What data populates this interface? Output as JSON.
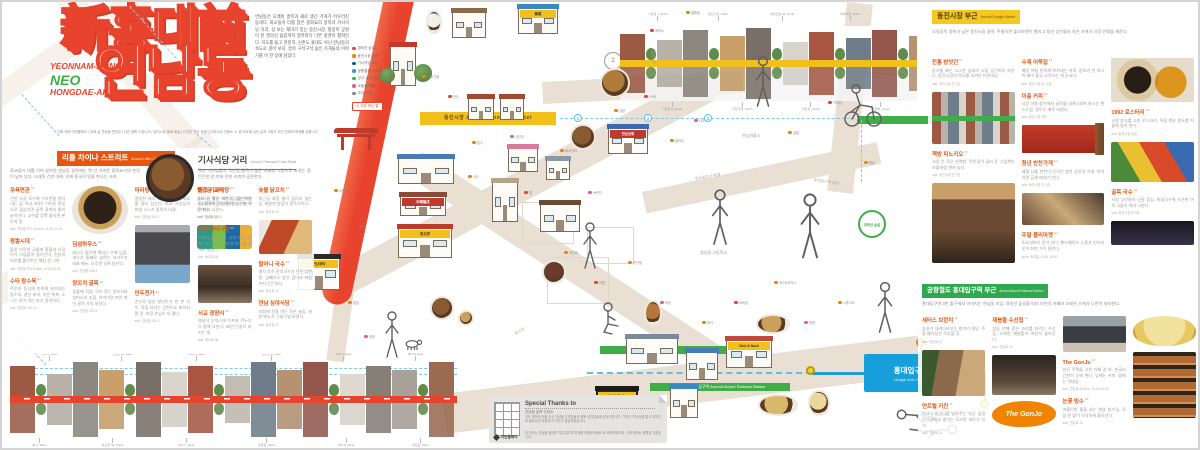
{
  "title": {
    "line1": "新홍대前",
    "line2": "연남동",
    "sub1": "YEONNAM-DONG,",
    "sub2": "NEO",
    "sub3": "HONGDAE-AP",
    "credits": "기획·제작 어반플레이 | 취재·글 연남동 편집부 | 사진 골목 스튜디오 | 일러스트 동네 화실 | 디자인 연남 공방 | 인쇄 서교 인쇄소 ※ 본 지도에 실린 글과 그림의 무단 전재와 복제를 금합니다"
  },
  "intro": {
    "text": "연남동은 오래된 골목과 새로 생긴 가게가 어우러진 동네다. 화교들이 터를 잡은 중화요리 골목과 기사식당 거리, 장 보는 재미가 있는 동진시장, 철길이 공원이 된 경의선 숲길까지 골목마다 다른 풍경이 펼쳐진다. 지도를 들고 천천히, 신촌도 홍대도 아닌 연남동의 속도로 걸어 보자. 골목 구석구석 숨은 가게들의 이야기를 이 한 장에 담았다.",
    "tag": "※ 지도 보는 법",
    "legend": [
      {
        "c": "#e8432c",
        "l": "경의선 숲길"
      },
      {
        "c": "#f08300",
        "l": "동진시장 골목"
      },
      {
        "c": "#1f4e9c",
        "l": "기사식당 거리"
      },
      {
        "c": "#2a9bd6",
        "l": "공항철도·지하철"
      },
      {
        "c": "#3fae49",
        "l": "걷고 싶은 거리"
      },
      {
        "c": "#e85c8a",
        "l": "소품샵·책방"
      },
      {
        "c": "#8a8a8a",
        "l": "주차 가능"
      }
    ]
  },
  "left": {
    "bannerA_ko": "리틀 차이나 스트리트",
    "bannerA_en": "Around Little China Street",
    "introA": "화교들이 대를 이어 살아온 연남동 골목에는 백 년 가까운 중화요리의 손맛이 남아 있다. 오래된 간판 아래, 진짜 중국의 맛을 만나는 거리.",
    "headB_ko": "기사식당 거리",
    "headB_en": "Around Transport Cafe Road",
    "introB": "택시 기사님들의 백반집 골목이 젊은 카페와 식당으로 바뀌는 중. 든든한 한 끼와 진한 커피가 공존한다.",
    "itemsA": [
      {
        "t": "우육면관",
        "s": "C2",
        "b": "진한 사골 육수에 수타면을 말아내는 집. 화교 3대가 이어온 손맛으로 점심이면 골목 끝까지 줄이 늘어선다. 고수를 듬뿍 올리면 본토의 맛.",
        "a": "add. 연남동 227-15 time. 11:00-21:00"
      },
      {
        "t": "짬뽕시대",
        "s": "C3",
        "b": "불맛 가득한 국물에 홍합과 오징어가 아낌없이 들어간다. 전날의 피로를 풀어주는 해장 한 그릇.",
        "a": "add. 연남동 229-3 time. 10:30-20:30"
      },
      {
        "t": "수타 탕수육",
        "s": "B2",
        "b": "주문과 동시에 반죽해 튀겨내는 탕수육. 겉은 바삭, 속은 촉촉. 소스는 부어 먹는 파가 정석이다.",
        "a": "add. 연남동 240-12"
      },
      {
        "ph": "p-jajang",
        "h": 48
      },
      {
        "t": "딤섬하우스",
        "s": "B3",
        "b": "대나무 찜기에 쪄내는 수제 딤섬. 새우가 통째로 씹히는 하가우가 대표 메뉴. 오후엔 일찍 동난다.",
        "a": "add. 연남동 248-9"
      },
      {
        "t": "양꼬치 골목",
        "s": "A2",
        "b": "숯불에 직접 구워 먹는 양꼬치와 칭따오의 조합. 저녁이면 쯔란 향이 골목 가득 퍼진다.",
        "a": "add. 연남동 257-6"
      },
      {
        "t": "마라탕",
        "s": "A3",
        "b": "얼얼한 마라 국물에 원하는 재료를 골라 담는다. 화교 사장님의 비법 소스가 중독의 비결.",
        "a": "add. 연남동 260-1"
      },
      {
        "ph": "p-man",
        "h": 58
      },
      {
        "t": "만두전가",
        "s": "B4",
        "b": "손으로 빚은 왕만두가 한 판 가득. 육즙 터지는 군만두도 놓치지 말 것. 포장 손님이 더 많다.",
        "a": "add. 연남동 251-2"
      },
      {
        "t": "빨간문 교자",
        "s": "A4",
        "b": "골목 끝 빨간 대문 집. 물만두와 고추잡채가 단골들의 일순위 주문이다.",
        "a": "add. 연남동 255-8"
      },
      {
        "ph": "p-cans",
        "h": 24
      }
    ],
    "itemsB": [
      {
        "t": "원조 기사식당",
        "s": "D2",
        "b": "24시간 불이 꺼지지 않는 백반집. 제육볶음에 계란찜이 기본으로 따라 나온다.",
        "a": "add. 동교로 51"
      },
      {
        "t": "연남 제비다방",
        "s": "D3",
        "b": "기사식당 자리를 고쳐 만든 카페. 낡은 간판과 타일 바닥을 그대로 살렸다.",
        "a": "add. 동교로 46"
      },
      {
        "ph": "p-interior",
        "h": 38
      },
      {
        "t": "서교 경양식",
        "s": "D4",
        "b": "옛날식 돈까스에 수프와 깍두기가 함께 나온다. 30년 단골이 지키는 맛.",
        "a": "add. 동교로 38"
      },
      {
        "t": "숯불 닭꼬치",
        "s": "E2",
        "b": "퇴근길 포장 줄이 끊이지 않는 집. 매콤한 양념이 중독적이다.",
        "a": "add. 동교로 29"
      },
      {
        "ph": "p-hotdog",
        "h": 34
      },
      {
        "t": "할머니 국수",
        "s": "E3",
        "b": "멸치 육수 잔치국수가 단돈 삼천 원. 곱빼기도 같은 값이라 마음까지 든든하다.",
        "a": "add. 동교로 22"
      },
      {
        "t": "연남 심야식당",
        "s": "E4",
        "b": "자정에 문을 여는 작은 술집. 칠판 메뉴가 그날그날 바뀐다.",
        "a": "add. 동교로 17"
      }
    ]
  },
  "right": {
    "bannerC_ko": "동진시장 부근",
    "bannerC_en": "Around Dongjin Market",
    "introC": "오일장의 정취가 남은 동진시장 골목. 주말이면 플리마켓이 열리고 청년 상인들의 작은 가게가 시장 안팎을 채운다.",
    "itemsC": [
      {
        "t": "전통 방앗간",
        "s": "F2",
        "b": "참기름 짜는 고소한 냄새가 시장 입구까지 퍼진다. 동진시장의 역사를 지켜온 터줏대감.",
        "a": "add. 동진시장 안 1호"
      },
      {
        "ph": "p-market",
        "h": 52
      },
      {
        "t": "책방 피노키오",
        "s": "F3",
        "b": "시장 안 작은 헌책방. 주인장이 골라 둔 그림책이 보물처럼 쌓여 있다.",
        "a": "add. 동진시장 안 7호"
      },
      {
        "ph": "p-stall",
        "h": 80
      },
      {
        "t": "수제 어묵집",
        "s": "F4",
        "b": "매일 아침 반죽해 튀겨내는 어묵. 장보기 전 하나씩 베어 물고 시작하는 게 순서다.",
        "a": "add. 동진시장 안 12호"
      },
      {
        "t": "이층 커피",
        "s": "G2",
        "b": "시장 이층 창가에서 골목을 내려다보며 마시는 핸드드립. 원두는 매주 바뀐다.",
        "a": "add. 동진시장 2층"
      },
      {
        "ph": "p-pack",
        "h": 28
      },
      {
        "t": "청년 반찬가게",
        "s": "G3",
        "b": "제철 나물 반찬이 인기인 청년 상인의 가게. 저녁이면 금세 매대가 빈다.",
        "a": "add. 동진시장 안 3호"
      },
      {
        "ph": "p-shelf",
        "h": 32
      },
      {
        "t": "주말 플리마켓",
        "s": "G4",
        "b": "토요일마다 장이 선다. 핸드메이드 소품과 빈티지 옷이 좌판 가득 깔린다.",
        "a": "open. 토요일 13:00-18:00"
      },
      {
        "ph": "p-plates",
        "h": 44
      },
      {
        "t": "1992 로스터리",
        "s": "H2",
        "b": "시장 창고를 고친 로스터리. 직접 볶은 원두를 저울에 달아 판다.",
        "a": "add. 동진시장 뒷길"
      },
      {
        "ph": "p-paint",
        "h": 40
      },
      {
        "t": "골목 국수",
        "s": "H3",
        "b": "시장 상인들의 단골 점심. 비빔국수에 뜨끈한 어묵 국물이 따라 나온다.",
        "a": "add. 동진시장 안 9호"
      },
      {
        "ph": "p-night",
        "h": 24
      }
    ],
    "bannerD_ko": "공항철도 홍대입구역 부근",
    "bannerD_en": "Around Airport Railroad Station",
    "introD": "홍대입구역 3번 출구에서 이어지는 연남동 초입. 경의선 숲길을 따라 브런치 카페와 오래된 가게가 나란히 자리한다.",
    "itemsD": [
      {
        "t": "세터스 브런치",
        "s": "J2",
        "b": "숲길이 내려다보이는 창가가 명당. 주말 웨이팅은 각오할 것.",
        "a": "add. 연남로 27"
      },
      {
        "ph": "p-rest",
        "h": 46
      },
      {
        "t": "연트럴 키친",
        "s": "J3",
        "b": "피크닉 바구니를 빌려주는 식당. 숲길 잔디밭에서 즐기는 도시락 세트가 인기.",
        "a": "add. 연남로 31"
      },
      {
        "t": "재봉틀 수선집",
        "s": "J4",
        "b": "삼십 년째 같은 자리를 지키는 수선집. 오래된 재봉틀이 여전히 돌아간다.",
        "a": "add. 연남로 19"
      },
      {
        "ph": "p-sew",
        "h": 40
      },
      {
        "ph": "p-gonjo",
        "h": 26,
        "txt": "The GonJo"
      },
      {
        "ph": "p-front",
        "h": 36
      },
      {
        "t": "The GonJo",
        "s": "K2",
        "b": "낡은 주택을 고친 카페 겸 바. 손글씨 간판이 눈에 띈다. 낮에는 커피, 밤에는 칵테일.",
        "a": "add. 연남로 48 time. 12:00-24:00"
      },
      {
        "t": "눈꽃 빙수",
        "s": "K3",
        "b": "여름이면 줄을 서는 옛날 빙수집. 직접 쑨 팥이 넉넉하게 올라간다.",
        "a": "add. 연남로 44"
      },
      {
        "ph": "p-bingsu",
        "h": 30
      },
      {
        "ph": "p-bake",
        "h": 66
      },
      {
        "t": "빵 굽는 오븐",
        "s": "K4",
        "b": "새벽부터 구워내는 식빵이 문 열자마자 동난다. 버터 향이 골목까지.",
        "a": "add. 연남로 52"
      }
    ]
  },
  "map": {
    "red_band_label": "경의선숲길공원 Gyeongui Line Forest Park",
    "yellow_road": "동진시장 Around Dongjin Market",
    "green_bar": "공항철도 홍대입구역 Around Airport Railroad Station",
    "station_ko": "홍대입구역",
    "station_en": "Hongik Univ. Station",
    "badge": "경의선 숲길",
    "circle_badge": "2",
    "num1": "1",
    "num2": "2",
    "num3": "3",
    "area1": "연남파출소",
    "area2": "경성중·고등학교",
    "road1": "← 연트럴파크 방향",
    "road2": "홍대입구역 방면 →",
    "road3": "동교로",
    "road4": "성미산로",
    "markers": [
      {
        "x": 332,
        "y": 186,
        "c": "#f08300",
        "l": "소품샵"
      },
      {
        "x": 352,
        "y": 222,
        "c": "#e8432c",
        "l": "책방"
      },
      {
        "x": 346,
        "y": 298,
        "c": "#f08300",
        "l": "꽃집"
      },
      {
        "x": 362,
        "y": 332,
        "c": "#e85c8a",
        "l": "공방"
      },
      {
        "x": 420,
        "y": 72,
        "c": "#f08300",
        "l": "카페 연남"
      },
      {
        "x": 446,
        "y": 92,
        "c": "#e8432c",
        "l": "만두"
      },
      {
        "x": 470,
        "y": 138,
        "c": "#f08300",
        "l": "분식"
      },
      {
        "x": 508,
        "y": 132,
        "c": "#e85c8a",
        "l": "사진관"
      },
      {
        "x": 466,
        "y": 172,
        "c": "#f08300",
        "l": "국수"
      },
      {
        "x": 522,
        "y": 188,
        "c": "#e8432c",
        "l": "펍"
      },
      {
        "x": 558,
        "y": 146,
        "c": "#f08300",
        "l": "베이커리"
      },
      {
        "x": 586,
        "y": 188,
        "c": "#e85c8a",
        "l": "브런치"
      },
      {
        "x": 612,
        "y": 106,
        "c": "#f08300",
        "l": "김밥"
      },
      {
        "x": 642,
        "y": 92,
        "c": "#e8432c",
        "l": "LP바"
      },
      {
        "x": 668,
        "y": 136,
        "c": "#f08300",
        "l": "갤러리"
      },
      {
        "x": 692,
        "y": 116,
        "c": "#e85c8a",
        "l": "타코"
      },
      {
        "x": 562,
        "y": 248,
        "c": "#f08300",
        "l": "와인바"
      },
      {
        "x": 592,
        "y": 278,
        "c": "#e8432c",
        "l": "라멘"
      },
      {
        "x": 626,
        "y": 258,
        "c": "#f08300",
        "l": "문구점"
      },
      {
        "x": 658,
        "y": 298,
        "c": "#e85c8a",
        "l": "떡집"
      },
      {
        "x": 700,
        "y": 318,
        "c": "#f08300",
        "l": "피자"
      },
      {
        "x": 732,
        "y": 298,
        "c": "#e8432c",
        "l": "바버샵"
      },
      {
        "x": 772,
        "y": 278,
        "c": "#f08300",
        "l": "게스트하우스"
      },
      {
        "x": 802,
        "y": 318,
        "c": "#e85c8a",
        "l": "마켓"
      },
      {
        "x": 836,
        "y": 298,
        "c": "#f08300",
        "l": "스튜디오"
      },
      {
        "x": 648,
        "y": 26,
        "c": "#e8432c",
        "l": "세탁소"
      },
      {
        "x": 684,
        "y": 8,
        "c": "#f08300",
        "l": "철물점"
      },
      {
        "x": 786,
        "y": 128,
        "c": "#f08300",
        "l": "살롱"
      },
      {
        "x": 826,
        "y": 98,
        "c": "#e8432c",
        "l": "커피집"
      },
      {
        "x": 862,
        "y": 158,
        "c": "#f08300",
        "l": "빵집"
      }
    ],
    "buildings": [
      {
        "x": 388,
        "y": 44,
        "w": 26,
        "h": 40,
        "r": "#c0392b"
      },
      {
        "x": 378,
        "y": 66,
        "w": 15,
        "h": 15,
        "cls": "bush"
      },
      {
        "x": 412,
        "y": 62,
        "w": 18,
        "h": 18,
        "cls": "bush"
      },
      {
        "x": 396,
        "y": 156,
        "w": 56,
        "h": 26,
        "r": "#4a7ab5"
      },
      {
        "x": 398,
        "y": 194,
        "w": 46,
        "h": 20,
        "r": "#8a4a3a",
        "sign": "中華飯店",
        "sgc": "#c0392b"
      },
      {
        "x": 396,
        "y": 226,
        "w": 54,
        "h": 30,
        "r": "#c0392b",
        "sign": "老北京"
      },
      {
        "x": 450,
        "y": 10,
        "w": 34,
        "h": 26,
        "r": "#8a6a4a"
      },
      {
        "x": 516,
        "y": 6,
        "w": 40,
        "h": 26,
        "r": "#3a8ac0",
        "sign": "雜貨"
      },
      {
        "x": 466,
        "y": 96,
        "w": 26,
        "h": 22,
        "r": "#a04a32"
      },
      {
        "x": 498,
        "y": 96,
        "w": 24,
        "h": 22,
        "r": "#a04a32"
      },
      {
        "x": 506,
        "y": 146,
        "w": 30,
        "h": 24,
        "r": "#d87a9a"
      },
      {
        "x": 544,
        "y": 158,
        "w": 24,
        "h": 20,
        "r": "#8a9aa8"
      },
      {
        "x": 490,
        "y": 180,
        "w": 26,
        "h": 40,
        "r": "#b5a488"
      },
      {
        "x": 538,
        "y": 202,
        "w": 40,
        "h": 28,
        "r": "#6a4a32"
      },
      {
        "x": 606,
        "y": 126,
        "w": 40,
        "h": 26,
        "r": "#3a6ab5",
        "sign": "연남상회",
        "sgc": "#c0392b"
      },
      {
        "x": 336,
        "y": 126,
        "w": 36,
        "h": 22,
        "cls": "gate"
      },
      {
        "x": 296,
        "y": 256,
        "w": 42,
        "h": 32,
        "r": "#2b2b2b",
        "sign": "연남세탁"
      },
      {
        "x": 624,
        "y": 336,
        "w": 52,
        "h": 26,
        "r": "#7a8a96"
      },
      {
        "x": 684,
        "y": 350,
        "w": 32,
        "h": 28,
        "r": "#4a7ab5"
      },
      {
        "x": 724,
        "y": 338,
        "w": 46,
        "h": 28,
        "r": "#c04a3a",
        "sign": "Nick & Nack"
      },
      {
        "x": 594,
        "y": 388,
        "w": 42,
        "h": 36,
        "r": "#1a1a1a",
        "cls": "bella",
        "sign": "Bella Bella"
      },
      {
        "x": 668,
        "y": 386,
        "w": 28,
        "h": 30,
        "r": "#3a8ac0"
      },
      {
        "x": 568,
        "y": 122,
        "w": 26,
        "h": 26,
        "cls": "food",
        "c": "#8a5a30"
      },
      {
        "x": 598,
        "y": 66,
        "w": 30,
        "h": 30,
        "cls": "food",
        "c": "#b07a3a"
      },
      {
        "x": 540,
        "y": 258,
        "w": 24,
        "h": 24,
        "cls": "food",
        "c": "#6a3a2a"
      },
      {
        "x": 428,
        "y": 294,
        "w": 24,
        "h": 24,
        "cls": "food",
        "c": "#8a5a30"
      },
      {
        "x": 456,
        "y": 308,
        "w": 16,
        "h": 16,
        "cls": "food",
        "c": "#caa05a"
      },
      {
        "x": 754,
        "y": 312,
        "w": 34,
        "h": 20,
        "cls": "food",
        "c": "#caa05a"
      },
      {
        "x": 806,
        "y": 388,
        "w": 22,
        "h": 26,
        "cls": "food",
        "c": "#e8d89a"
      },
      {
        "x": 756,
        "y": 392,
        "w": 40,
        "h": 22,
        "cls": "food",
        "c": "#d8b86a"
      },
      {
        "x": 642,
        "y": 298,
        "w": 18,
        "h": 26,
        "cls": "food",
        "c": "#b5763a"
      },
      {
        "x": 424,
        "y": 8,
        "w": 16,
        "h": 24,
        "cls": "food",
        "c": "#f2f0ec"
      }
    ]
  },
  "strips": {
    "bottom": [
      {
        "h": 30,
        "c": "#9c5a45"
      },
      {
        "t": 1
      },
      {
        "h": 22,
        "c": "#b8b2a8"
      },
      {
        "h": 36,
        "c": "#8c8880"
      },
      {
        "h": 26,
        "c": "#caa06a"
      },
      {
        "t": 1
      },
      {
        "h": 34,
        "c": "#7a6f66"
      },
      {
        "h": 24,
        "c": "#d8d4cc"
      },
      {
        "h": 30,
        "c": "#a85642"
      },
      {
        "t": 1
      },
      {
        "h": 20,
        "c": "#c2bcb2"
      },
      {
        "h": 34,
        "c": "#6f7d8a"
      },
      {
        "h": 26,
        "c": "#b49272"
      },
      {
        "h": 36,
        "c": "#94564a"
      },
      {
        "t": 1
      },
      {
        "h": 22,
        "c": "#ddd8d0"
      },
      {
        "h": 30,
        "c": "#857f76"
      },
      {
        "h": 26,
        "c": "#a8a199"
      },
      {
        "t": 1
      },
      {
        "h": 34,
        "c": "#9c6a50"
      }
    ],
    "top": [
      {
        "h": 26,
        "c": "#9c5a45"
      },
      {
        "t": 1
      },
      {
        "h": 20,
        "c": "#b8b2a8"
      },
      {
        "h": 30,
        "c": "#8c8880"
      },
      {
        "t": 1
      },
      {
        "h": 24,
        "c": "#caa06a"
      },
      {
        "h": 32,
        "c": "#7a6f66"
      },
      {
        "t": 1
      },
      {
        "h": 18,
        "c": "#d8d4cc"
      },
      {
        "h": 28,
        "c": "#a85642"
      },
      {
        "t": 1
      },
      {
        "h": 22,
        "c": "#6f7d8a"
      },
      {
        "h": 30,
        "c": "#94564a"
      },
      {
        "t": 1
      },
      {
        "h": 24,
        "c": "#b49272"
      }
    ],
    "labels_bottom_top": [
      {
        "x": 32,
        "l": "227-3_East"
      },
      {
        "x": 102,
        "l": "연남로 11_East"
      },
      {
        "x": 178,
        "l": "240-12_East"
      },
      {
        "x": 252,
        "l": "성미산로_East"
      },
      {
        "x": 326,
        "l": "190-2_East"
      },
      {
        "x": 398,
        "l": "66-10_East"
      }
    ],
    "labels_bottom_bot": [
      {
        "x": 22,
        "l": "48-3_West"
      },
      {
        "x": 92,
        "l": "동교로 38_West"
      },
      {
        "x": 168,
        "l": "212-7_West"
      },
      {
        "x": 248,
        "l": "후문길_West"
      },
      {
        "x": 328,
        "l": "201-8_West"
      },
      {
        "x": 402,
        "l": "세모길_West"
      }
    ],
    "labels_top": [
      {
        "x": 28,
        "l": "시장길 4_North"
      },
      {
        "x": 88,
        "l": "동진시장_North"
      },
      {
        "x": 150,
        "l": "성미산로 28_North"
      },
      {
        "x": 220,
        "l": "우체국앞_North"
      }
    ],
    "labels_top_bot": [
      {
        "x": 42,
        "l": "시장길 5_South"
      },
      {
        "x": 112,
        "l": "진진가게_South"
      },
      {
        "x": 182,
        "l": "연남장_South"
      },
      {
        "x": 252,
        "l": "복덕방_South"
      }
    ]
  },
  "thanks": {
    "title": "Special Thanks to",
    "sub": "연남동 골목 안내소",
    "p1": "지도 제작에 도움 주신 연남동 주민분들과 골목 상인분들께 감사드립니다. 기꺼이 가게 문을 열고 이야기를 들려주신 덕분에 이 지도가 완성되었습니다.",
    "p2": "본 지도는 연남동 일대를 직접 걸으며 취재한 내용을 바탕으로 제작되었으며, 가게 정보는 발행일 기준입니다.",
    "logo": "어반플레이"
  }
}
